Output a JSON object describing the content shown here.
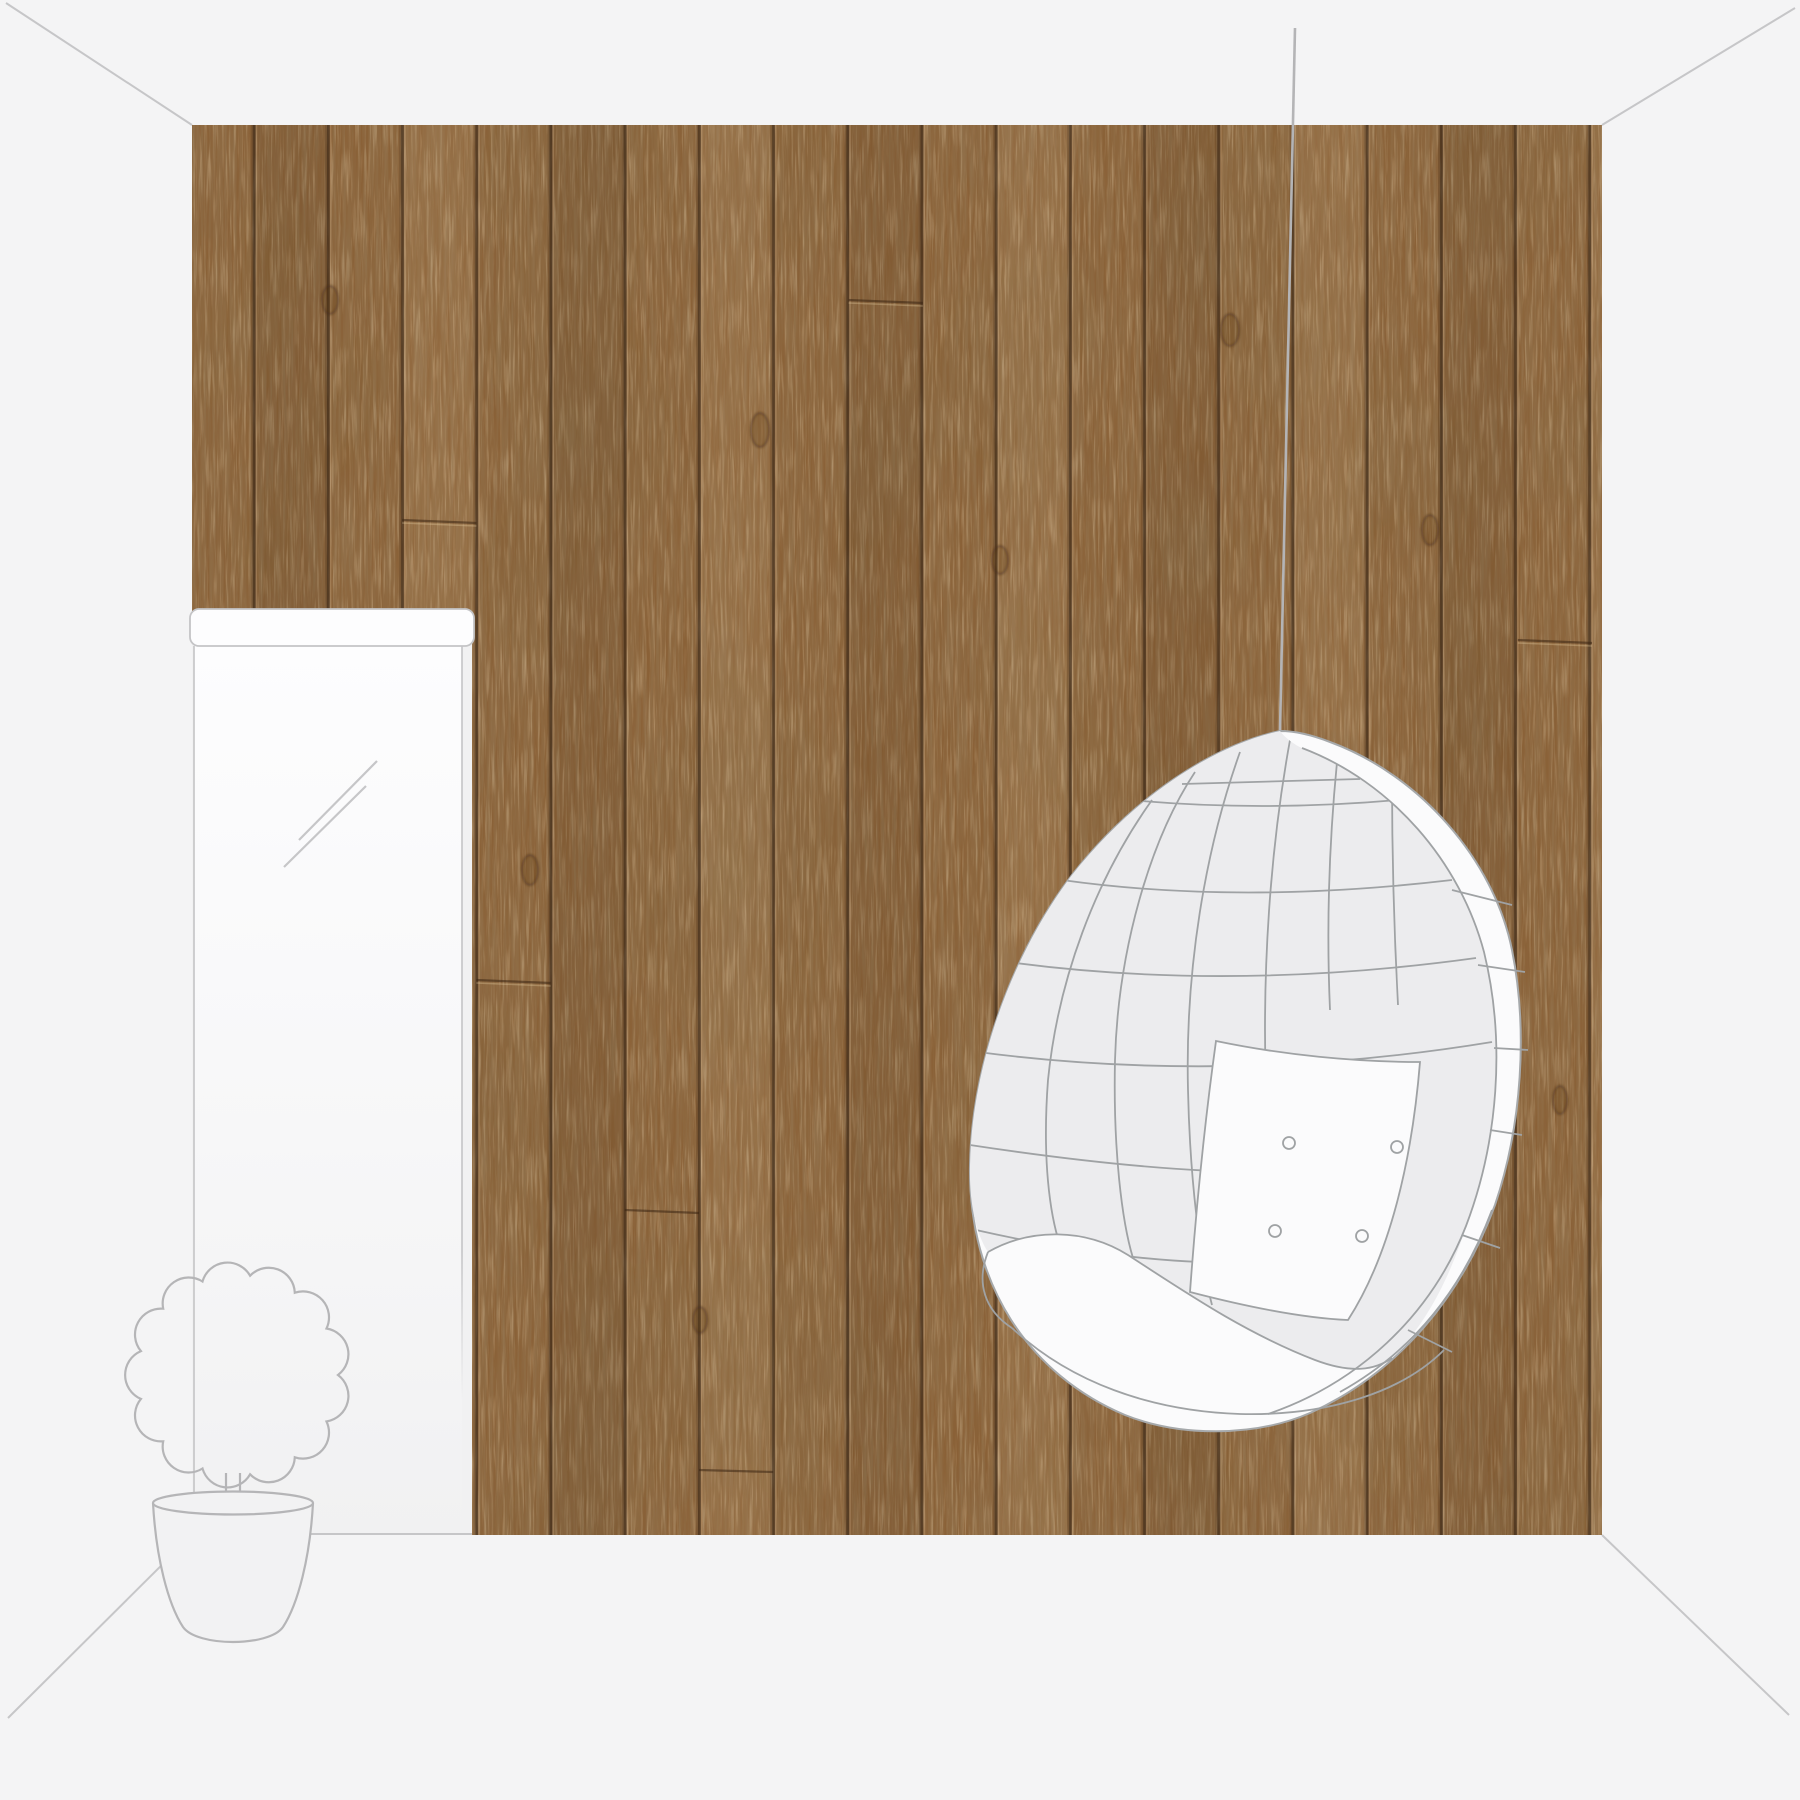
{
  "meta": {
    "type": "room-mockup",
    "description": "Room visualization: rustic wood plank wallpaper wall with hanging egg chair, window with valance and potted topiary plant"
  },
  "palette": {
    "background": "#f4f4f5",
    "guide_line": "#c6c6c8",
    "wood_base": "#8a6137",
    "wood_dark": "#5d4025",
    "wood_light": "#b08a58",
    "window_frame": "#c4c4c6",
    "window_strip_bg": "#f1f1f2",
    "window_glass_top": "#fdfdfe",
    "valance_fill": "#fdfdfe",
    "sketch_line": "#9fa2a4",
    "chair_shell": "#ececee",
    "chair_white": "#fbfbfc",
    "cord": "#b4b4b6",
    "plant_line": "#b5b5b7",
    "pot_fill": "#f2f2f3"
  },
  "scene": {
    "wall_label": "wood plank wallpaper wall",
    "plank_count": 19,
    "window_label": "window with valance",
    "chair_label": "hanging egg chair",
    "chair_button_count": 4,
    "cushion_label": "seat cushion",
    "pillow_label": "tufted back pillow",
    "plant_label": "potted topiary plant",
    "cord_label": "hanging cord"
  }
}
